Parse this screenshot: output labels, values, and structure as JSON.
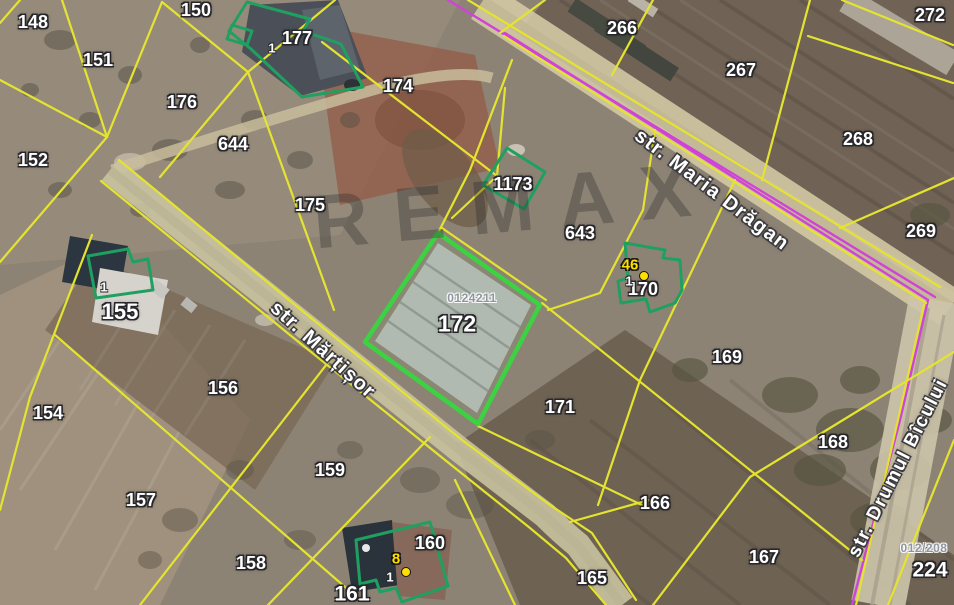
{
  "map": {
    "watermark": {
      "text": "REMAX",
      "x": 515,
      "y": 206,
      "rotation": -5
    },
    "colors": {
      "parcel_line_yellow": "#e4e430",
      "selection_green": "#1fa060",
      "highlight_green": "#3bd342",
      "boundary_magenta": "#cf43d6",
      "marker_yellow": "#ffdf00",
      "label_white": "#ffffff",
      "cadastral_code_gray": "#8e959d"
    },
    "streets": [
      {
        "id": "maria-dragan",
        "name": "str. Maria Drăgan",
        "x": 712,
        "y": 190,
        "rotation": 37,
        "font_size": 20
      },
      {
        "id": "martisor",
        "name": "str. Mărțișor",
        "x": 323,
        "y": 350,
        "rotation": 42,
        "font_size": 20
      },
      {
        "id": "drumul-bicului",
        "name": "str. Drumul Bîcului",
        "x": 898,
        "y": 468,
        "rotation": -63,
        "font_size": 19
      }
    ],
    "parcel_labels": [
      {
        "text": "148",
        "x": 33,
        "y": 22
      },
      {
        "text": "150",
        "x": 196,
        "y": 10
      },
      {
        "text": "151",
        "x": 98,
        "y": 60
      },
      {
        "text": "177",
        "x": 297,
        "y": 38
      },
      {
        "text": "176",
        "x": 182,
        "y": 102
      },
      {
        "text": "644",
        "x": 233,
        "y": 144
      },
      {
        "text": "174",
        "x": 398,
        "y": 86
      },
      {
        "text": "152",
        "x": 33,
        "y": 160
      },
      {
        "text": "175",
        "x": 310,
        "y": 205
      },
      {
        "text": "266",
        "x": 622,
        "y": 28
      },
      {
        "text": "267",
        "x": 741,
        "y": 70
      },
      {
        "text": "272",
        "x": 930,
        "y": 15
      },
      {
        "text": "268",
        "x": 858,
        "y": 139
      },
      {
        "text": "269",
        "x": 921,
        "y": 231
      },
      {
        "text": "1173",
        "x": 513,
        "y": 184
      },
      {
        "text": "643",
        "x": 580,
        "y": 233
      },
      {
        "text": "170",
        "x": 643,
        "y": 289
      },
      {
        "text": "155",
        "x": 120,
        "y": 312,
        "size": 22
      },
      {
        "text": "156",
        "x": 223,
        "y": 388
      },
      {
        "text": "154",
        "x": 48,
        "y": 413
      },
      {
        "text": "172",
        "x": 457,
        "y": 324,
        "size": 23
      },
      {
        "text": "171",
        "x": 560,
        "y": 407
      },
      {
        "text": "169",
        "x": 727,
        "y": 357
      },
      {
        "text": "168",
        "x": 833,
        "y": 442
      },
      {
        "text": "157",
        "x": 141,
        "y": 500
      },
      {
        "text": "159",
        "x": 330,
        "y": 470
      },
      {
        "text": "158",
        "x": 251,
        "y": 563
      },
      {
        "text": "160",
        "x": 430,
        "y": 543
      },
      {
        "text": "161",
        "x": 352,
        "y": 594,
        "size": 21
      },
      {
        "text": "165",
        "x": 592,
        "y": 578
      },
      {
        "text": "166",
        "x": 655,
        "y": 503
      },
      {
        "text": "167",
        "x": 764,
        "y": 557
      },
      {
        "text": "224",
        "x": 930,
        "y": 570,
        "size": 21
      }
    ],
    "house_number_labels": [
      {
        "text": "1",
        "x": 272,
        "y": 48
      },
      {
        "text": "1",
        "x": 104,
        "y": 287
      },
      {
        "text": "1",
        "x": 390,
        "y": 577
      },
      {
        "text": "1",
        "x": 629,
        "y": 281
      }
    ],
    "address_markers": [
      {
        "text": "46",
        "x": 630,
        "y": 265,
        "dot_x": 644,
        "dot_y": 276
      },
      {
        "text": "8",
        "x": 396,
        "y": 559,
        "dot_x": 406,
        "dot_y": 572
      }
    ],
    "cadastral_codes": [
      {
        "text": "0124211",
        "x": 472,
        "y": 298
      },
      {
        "text": "012/208",
        "x": 924,
        "y": 548
      }
    ]
  }
}
